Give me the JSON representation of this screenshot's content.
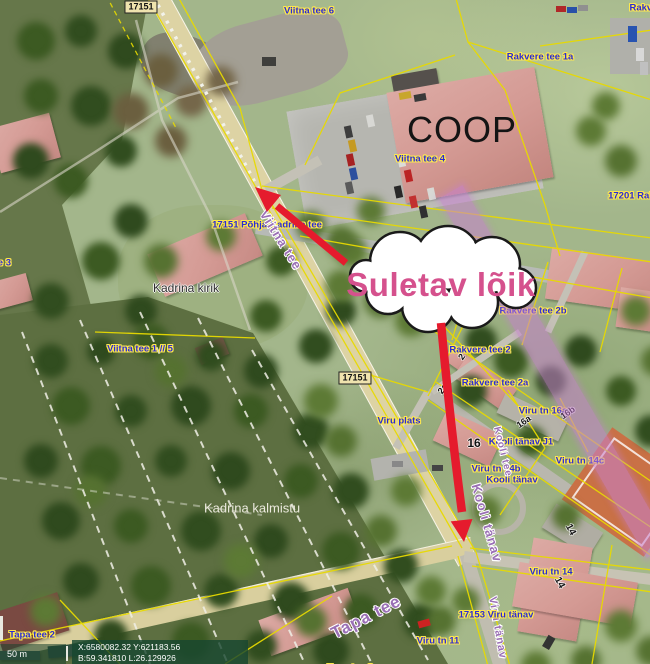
{
  "annotation": {
    "closure_label": "Suletav lõik"
  },
  "coop_sign": "COOP",
  "statusbar": {
    "scale_label": "50 m",
    "coord_xy": "X:6580082.32 Y:621183.56",
    "coord_bl": "B:59.341810 L:26.129926"
  },
  "colors": {
    "closure_text": "#d5518d",
    "closure_road_highlight": "#c77fd0",
    "arrow_red": "#e51b2d",
    "cadastral_line": "#e8da00",
    "cadastral_label": "#2b2bd4"
  },
  "labels": [
    {
      "id": "hwy-17151-top",
      "text": "17151",
      "x": 141,
      "y": 7,
      "cls": "cadbox"
    },
    {
      "id": "viitna-tee-6",
      "text": "Viitna tee 6",
      "x": 309,
      "y": 11,
      "cls": "cad"
    },
    {
      "id": "rakvere-cut",
      "text": "Rakvere",
      "x": 648,
      "y": 8,
      "cls": "cad"
    },
    {
      "id": "rakvere-tee-1a",
      "text": "Rakvere tee 1a",
      "x": 540,
      "y": 57,
      "cls": "cad"
    },
    {
      "id": "viitna-tee-4",
      "text": "Viitna tee 4",
      "x": 420,
      "y": 159,
      "cls": "cad"
    },
    {
      "id": "hwy-17201",
      "text": "17201 Rakv",
      "x": 634,
      "y": 196,
      "cls": "cad"
    },
    {
      "id": "hwy-17151-road",
      "text": "17151 Põhja-Kadrina tee",
      "x": 267,
      "y": 225,
      "cls": "cad"
    },
    {
      "id": "viitna-tee-name",
      "text": "Viitna tee",
      "x": 281,
      "y": 240,
      "rot": 58,
      "cls": "road",
      "size": 13
    },
    {
      "id": "kadrina-kirik",
      "text": "Kadrina kirik",
      "x": 186,
      "y": 288,
      "cls": "dark",
      "size": 12
    },
    {
      "id": "viitna-tee-1-5",
      "text": "Viitna tee 1 // 5",
      "x": 140,
      "y": 349,
      "cls": "cad"
    },
    {
      "id": "viitna-tee-3",
      "text": "Viitna tee 3",
      "x": -14,
      "y": 263,
      "cls": "cad"
    },
    {
      "id": "hwy-17151-mid",
      "text": "17151",
      "x": 355,
      "y": 378,
      "cls": "cadbox"
    },
    {
      "id": "viru-plats",
      "text": "Viru plats",
      "x": 399,
      "y": 421,
      "cls": "cad"
    },
    {
      "id": "rakvere-tee-2b",
      "text": "Rakvere tee 2b",
      "x": 533,
      "y": 311,
      "cls": "cad"
    },
    {
      "id": "rakvere-tee-2",
      "text": "Rakvere tee 2",
      "x": 480,
      "y": 350,
      "cls": "cad"
    },
    {
      "id": "rakvere-tee-2a",
      "text": "Rakvere tee 2a",
      "x": 495,
      "y": 383,
      "cls": "cad"
    },
    {
      "id": "viru-tn-16a",
      "text": "Viru tn 16a",
      "x": 543,
      "y": 411,
      "cls": "cad"
    },
    {
      "id": "parcel-16a",
      "text": "16a",
      "x": 524,
      "y": 422,
      "rot": -35,
      "cls": "num",
      "size": 9
    },
    {
      "id": "parcel-16b",
      "text": "16b",
      "x": 568,
      "y": 413,
      "rot": -35,
      "cls": "num",
      "size": 9
    },
    {
      "id": "parcel-16",
      "text": "16",
      "x": 474,
      "y": 443,
      "cls": "num",
      "size": 12
    },
    {
      "id": "kooli-tanav-j1",
      "text": "Kooli tänav J1",
      "x": 521,
      "y": 442,
      "cls": "cad"
    },
    {
      "id": "viru-tn-14b",
      "text": "Viru tn 14b",
      "x": 496,
      "y": 469,
      "cls": "cad"
    },
    {
      "id": "kooli-tanav",
      "text": "Kooli tänav",
      "x": 512,
      "y": 480,
      "cls": "cad"
    },
    {
      "id": "viru-tn-14c",
      "text": "Viru tn 14c",
      "x": 580,
      "y": 461,
      "cls": "cad"
    },
    {
      "id": "kooli-tee-name",
      "text": "Kooli tee",
      "x": 502,
      "y": 452,
      "rot": 76,
      "cls": "road",
      "size": 10
    },
    {
      "id": "kooli-tanav-name",
      "text": "Kooli tänav",
      "x": 487,
      "y": 523,
      "rot": 74,
      "cls": "road",
      "size": 13
    },
    {
      "id": "viru-tanav-name",
      "text": "Viru tänav",
      "x": 497,
      "y": 628,
      "rot": 80,
      "cls": "road",
      "size": 11
    },
    {
      "id": "kadrina-kalmistu",
      "text": "Kadrina kalmistu",
      "x": 252,
      "y": 508,
      "cls": "white",
      "size": 13
    },
    {
      "id": "viru-tn-14",
      "text": "Viru tn 14",
      "x": 551,
      "y": 572,
      "cls": "cad"
    },
    {
      "id": "parcel-14-gray",
      "text": "14",
      "x": 570,
      "y": 530,
      "rot": 62,
      "cls": "num",
      "size": 10
    },
    {
      "id": "parcel-14-pink",
      "text": "14",
      "x": 559,
      "y": 583,
      "rot": 62,
      "cls": "num",
      "size": 10
    },
    {
      "id": "viru-tanav-17153",
      "text": "17153 Viru tänav",
      "x": 496,
      "y": 615,
      "cls": "cad"
    },
    {
      "id": "viru-tn-11",
      "text": "Viru tn 11",
      "x": 438,
      "y": 641,
      "cls": "cad"
    },
    {
      "id": "tapa-tee-2",
      "text": "Tapa tee 2",
      "x": 32,
      "y": 635,
      "cls": "cad"
    },
    {
      "id": "tapa-tee-name",
      "text": "Tapa tee",
      "x": 366,
      "y": 617,
      "rot": -27,
      "cls": "road",
      "size": 17
    },
    {
      "id": "tapa-tee-3",
      "text": "Tapa tee 3",
      "x": 350,
      "y": 668,
      "cls": "cad"
    },
    {
      "id": "parcel-2",
      "text": "2",
      "x": 462,
      "y": 357,
      "rot": -55,
      "cls": "num",
      "size": 9
    },
    {
      "id": "parcel-2a",
      "text": "2a",
      "x": 443,
      "y": 389,
      "rot": -55,
      "cls": "num",
      "size": 9
    }
  ]
}
